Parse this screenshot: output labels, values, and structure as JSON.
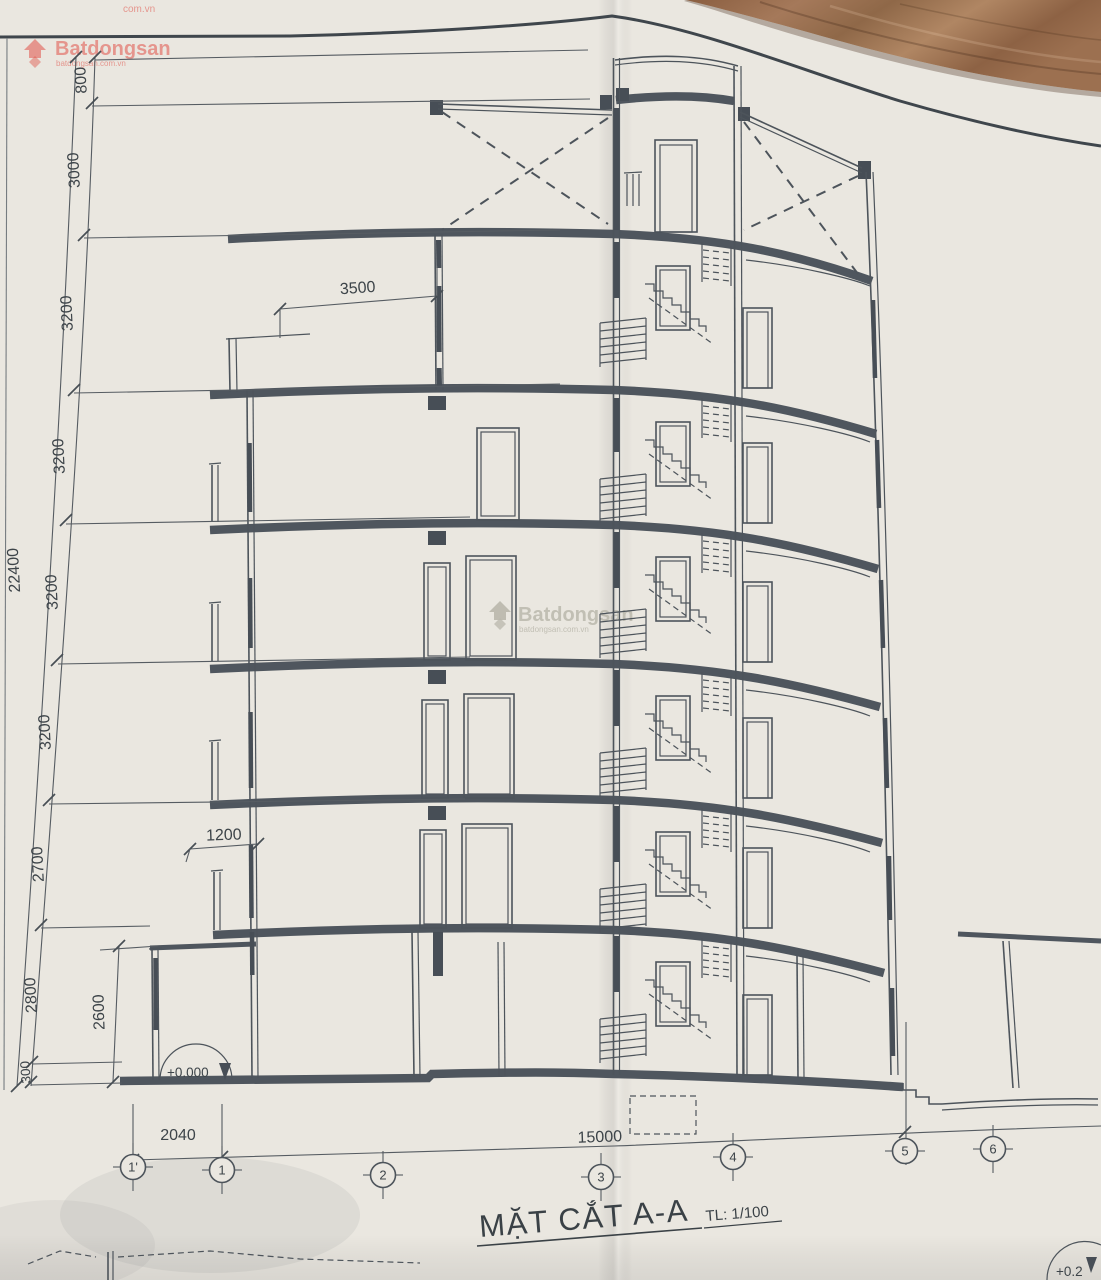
{
  "watermark": {
    "brand": "Batdongsan",
    "suffix": "com.vn",
    "tagline": "batdongsan.com.vn"
  },
  "title": {
    "name": "MẶT CẮT A-A",
    "scale": "TL: 1/100"
  },
  "level_markers": {
    "ground": "+0.000",
    "adjacent_partial": "+0.2"
  },
  "grid_axes": {
    "g1p": "1'",
    "g1": "1",
    "g2": "2",
    "g3": "3",
    "g4": "4",
    "g5": "5",
    "g6": "6"
  },
  "dim": {
    "v22400": "22400",
    "v800": "800",
    "v3000": "3000",
    "v3200": "3200",
    "v2700": "2700",
    "v2800": "2800",
    "v2600": "2600",
    "v300": "300",
    "v3500": "3500",
    "v1200": "1200",
    "v2040": "2040",
    "v15000": "15000"
  },
  "drawing_info": {
    "type": "building cross-section",
    "overall_height_mm": "22400",
    "overall_length_mm": "15000",
    "floor_heights_bottom_to_top_mm": [
      "300",
      "2800",
      "2700",
      "3200",
      "3200",
      "3200",
      "3200",
      "3000",
      "800"
    ],
    "grid_lines": [
      "1'",
      "1",
      "2",
      "3",
      "4",
      "5",
      "6"
    ]
  },
  "colors": {
    "paper": "#eae7e0",
    "ink": "#4d545b",
    "slab": "#4f565e",
    "watermark_red": "#e0524a",
    "wood": "#96694a"
  }
}
